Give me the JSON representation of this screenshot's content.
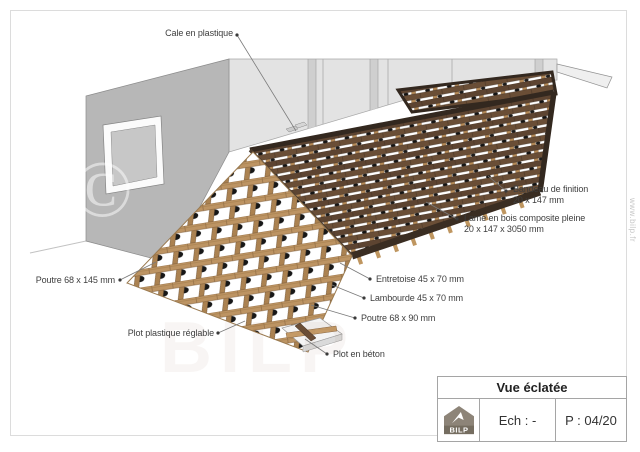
{
  "annotations": [
    {
      "id": "cale",
      "lines": [
        "Cale en plastique"
      ]
    },
    {
      "id": "bandeau",
      "lines": [
        "Bandeau de finition",
        "20 x 147 mm"
      ]
    },
    {
      "id": "lame",
      "lines": [
        "Lame en bois composite pleine",
        "20 x 147 x 3050 mm"
      ]
    },
    {
      "id": "entretoise",
      "lines": [
        "Entretoise 45 x 70 mm"
      ]
    },
    {
      "id": "lambourde",
      "lines": [
        "Lambourde 45 x 70 mm"
      ]
    },
    {
      "id": "poutre90",
      "lines": [
        "Poutre 68 x 90 mm"
      ]
    },
    {
      "id": "plot-beton",
      "lines": [
        "Plot en béton"
      ]
    },
    {
      "id": "plot-plastique",
      "lines": [
        "Plot plastique réglable"
      ]
    },
    {
      "id": "poutre145",
      "lines": [
        "Poutre 68 x 145 mm"
      ]
    }
  ],
  "title_block": {
    "title": "Vue éclatée",
    "scale": "Ech : -",
    "page": "P : 04/20",
    "logo": "BILP"
  },
  "watermarks": {
    "site": "www.bilp.fr",
    "copyright": "©",
    "brand": "BILP"
  },
  "colors": {
    "wood_tan": "#bd9463",
    "wood_dark": "#5d4431",
    "frame_dark": "#33281f",
    "wall_gray": "#b7b7b7",
    "wall_light": "#e3e3e3"
  }
}
